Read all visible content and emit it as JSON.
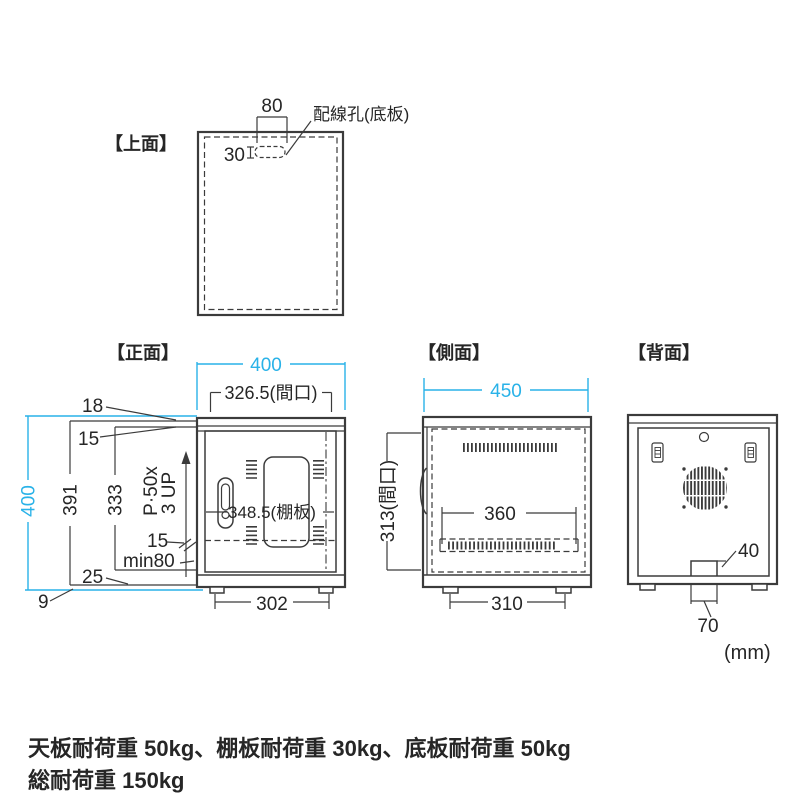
{
  "colors": {
    "line": "#3b3b3b",
    "accent": "#29b2e8",
    "text": "#262626"
  },
  "unit_label": "(mm)",
  "top_view": {
    "label": "【上面】",
    "dim_hole_width": "80",
    "dim_hole_height": "30",
    "note_wiring_hole": "配線孔(底板)"
  },
  "front_view": {
    "label": "【正面】",
    "dim_width_total": "400",
    "dim_width_opening": "326.5(間口)",
    "dim_top_18": "18",
    "dim_top_15": "15",
    "dim_height_total": "400",
    "dim_height_391": "391",
    "dim_height_333": "333",
    "dim_pitch_line1": "P·50x",
    "dim_pitch_line2": "3 UP",
    "dim_shelf_15": "15",
    "dim_min80": "min80",
    "dim_bottom_25": "25",
    "dim_foot_9": "9",
    "dim_shelf_width": "348.5(棚板)",
    "dim_foot_span": "302"
  },
  "side_view": {
    "label": "【側面】",
    "dim_depth_total": "450",
    "dim_height_opening": "313(間口)",
    "dim_shelf_depth": "360",
    "dim_foot_span": "310"
  },
  "back_view": {
    "label": "【背面】",
    "dim_notch_height": "40",
    "dim_notch_width": "70"
  },
  "footer": {
    "line1": "天板耐荷重 50kg、棚板耐荷重 30kg、底板耐荷重 50kg",
    "line2": "総耐荷重 150kg"
  }
}
